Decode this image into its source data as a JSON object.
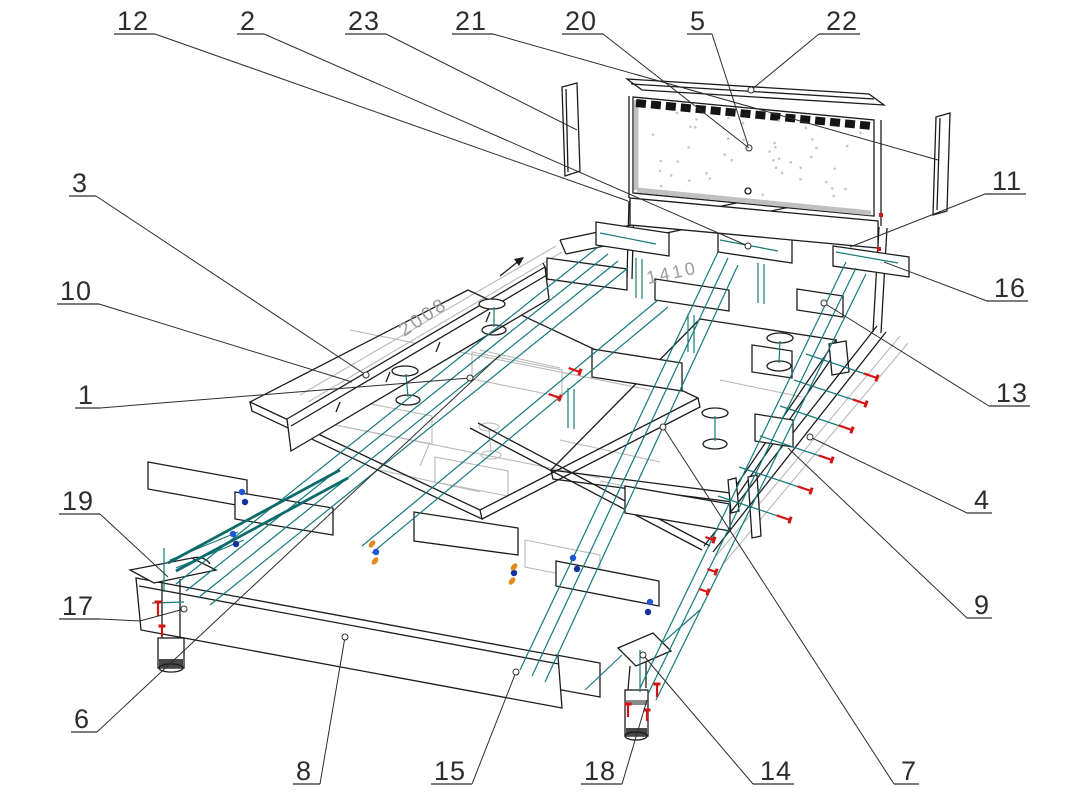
{
  "page": {
    "type": "exploded-assembly-drawing",
    "subject": "bed-frame",
    "background": "#ffffff"
  },
  "colors": {
    "outline": "#1c1c1c",
    "ghost": "#b9b9b9",
    "guide": "#157a7a",
    "guide_bold": "#0d6b6b",
    "screw": "#d41414",
    "fastener_blue": "#1e56d6",
    "fastener_blue_dark": "#12309e",
    "fastener_orange": "#e2891f",
    "label": "#2d2d2d",
    "dim": "#9b9b9b",
    "panel_dot": "#c6c6c6"
  },
  "dimensions": {
    "length": {
      "text": "2008",
      "x": 404,
      "y": 337,
      "angle": -33.5
    },
    "width": {
      "text": "1410",
      "x": 648,
      "y": 284,
      "angle": -12
    }
  },
  "callouts": [
    {
      "n": "1",
      "x": 78,
      "y": 404,
      "w": 15,
      "side": "r",
      "end": [
        470,
        378
      ],
      "circle": true
    },
    {
      "n": "2",
      "x": 240,
      "y": 30,
      "w": 17,
      "side": "r",
      "end": [
        748,
        246
      ],
      "circle": true
    },
    {
      "n": "3",
      "x": 72,
      "y": 192,
      "w": 17,
      "side": "r",
      "end": [
        366,
        375
      ],
      "circle": true
    },
    {
      "n": "4",
      "x": 974,
      "y": 509,
      "w": 15,
      "side": "l",
      "end": [
        810,
        437
      ],
      "circle": true
    },
    {
      "n": "5",
      "x": 690,
      "y": 30,
      "w": 15,
      "side": "r",
      "end": [
        749,
        148
      ],
      "circle": true
    },
    {
      "n": "6",
      "x": 74,
      "y": 728,
      "w": 16,
      "side": "r",
      "end": [
        500,
        355
      ],
      "circle": false
    },
    {
      "n": "7",
      "x": 901,
      "y": 780,
      "w": 15,
      "side": "l",
      "end": [
        663,
        427
      ],
      "circle": true
    },
    {
      "n": "8",
      "x": 296,
      "y": 780,
      "w": 17,
      "side": "r",
      "end": [
        345,
        637
      ],
      "circle": true
    },
    {
      "n": "9",
      "x": 974,
      "y": 614,
      "w": 15,
      "side": "l",
      "end": [
        788,
        448
      ],
      "circle": false
    },
    {
      "n": "10",
      "x": 60,
      "y": 300,
      "w": 32,
      "side": "r",
      "end": [
        352,
        382
      ],
      "circle": false
    },
    {
      "n": "11",
      "x": 992,
      "y": 190,
      "w": 31,
      "side": "l",
      "end": [
        850,
        247
      ],
      "circle": false
    },
    {
      "n": "12",
      "x": 117,
      "y": 30,
      "w": 31,
      "side": "r",
      "end": [
        628,
        201
      ],
      "circle": false
    },
    {
      "n": "13",
      "x": 996,
      "y": 402,
      "w": 31,
      "side": "l",
      "end": [
        824,
        303
      ],
      "circle": true
    },
    {
      "n": "14",
      "x": 760,
      "y": 780,
      "w": 31,
      "side": "l",
      "end": [
        643,
        655
      ],
      "circle": true
    },
    {
      "n": "15",
      "x": 434,
      "y": 780,
      "w": 31,
      "side": "r",
      "end": [
        516,
        672
      ],
      "circle": true
    },
    {
      "n": "16",
      "x": 994,
      "y": 297,
      "w": 31,
      "side": "l",
      "end": [
        884,
        262
      ],
      "circle": false
    },
    {
      "n": "17",
      "x": 62,
      "y": 615,
      "w": 31,
      "side": "r",
      "end": [
        184,
        609
      ],
      "circle": true,
      "via": [
        140,
        621
      ]
    },
    {
      "n": "18",
      "x": 584,
      "y": 780,
      "w": 31,
      "side": "r",
      "end": [
        647,
        700
      ],
      "circle": false
    },
    {
      "n": "19",
      "x": 62,
      "y": 510,
      "w": 31,
      "side": "r",
      "end": [
        168,
        577
      ],
      "circle": false
    },
    {
      "n": "20",
      "x": 565,
      "y": 30,
      "w": 31,
      "side": "r",
      "end": [
        749,
        148
      ],
      "circle": false
    },
    {
      "n": "21",
      "x": 455,
      "y": 30,
      "w": 31,
      "side": "r",
      "end": [
        938,
        160
      ],
      "circle": false
    },
    {
      "n": "22",
      "x": 826,
      "y": 30,
      "w": 31,
      "side": "l",
      "end": [
        751,
        90
      ],
      "circle": true
    },
    {
      "n": "23",
      "x": 348,
      "y": 30,
      "w": 31,
      "side": "r",
      "end": [
        577,
        130
      ],
      "circle": false
    }
  ],
  "fasteners": {
    "screws": [
      [
        877,
        378,
        199,
        14
      ],
      [
        866,
        404,
        199,
        14
      ],
      [
        852,
        430,
        199,
        14
      ],
      [
        832,
        460,
        199,
        14
      ],
      [
        811,
        491,
        199,
        14
      ],
      [
        790,
        520,
        199,
        14
      ],
      [
        580,
        372,
        199,
        12
      ],
      [
        560,
        398,
        199,
        12
      ],
      [
        716,
        572,
        199,
        9
      ],
      [
        708,
        592,
        199,
        9
      ],
      [
        714,
        540,
        199,
        9
      ],
      [
        158,
        602,
        90,
        14
      ],
      [
        162,
        626,
        90,
        10
      ],
      [
        628,
        704,
        90,
        13
      ],
      [
        657,
        684,
        90,
        13
      ],
      [
        647,
        710,
        90,
        11
      ]
    ],
    "red_dots": [
      [
        881,
        215
      ],
      [
        879,
        249
      ]
    ],
    "blue": [
      [
        242,
        492
      ],
      [
        245,
        502
      ],
      [
        233,
        534
      ],
      [
        236,
        544
      ],
      [
        573,
        558
      ],
      [
        577,
        569
      ],
      [
        650,
        602
      ],
      [
        648,
        612
      ],
      [
        376,
        552
      ],
      [
        514,
        573
      ]
    ],
    "orange": [
      [
        372,
        544
      ],
      [
        375,
        561
      ],
      [
        514,
        567
      ],
      [
        512,
        581
      ]
    ]
  },
  "headboard_dots": {
    "count": 44
  }
}
